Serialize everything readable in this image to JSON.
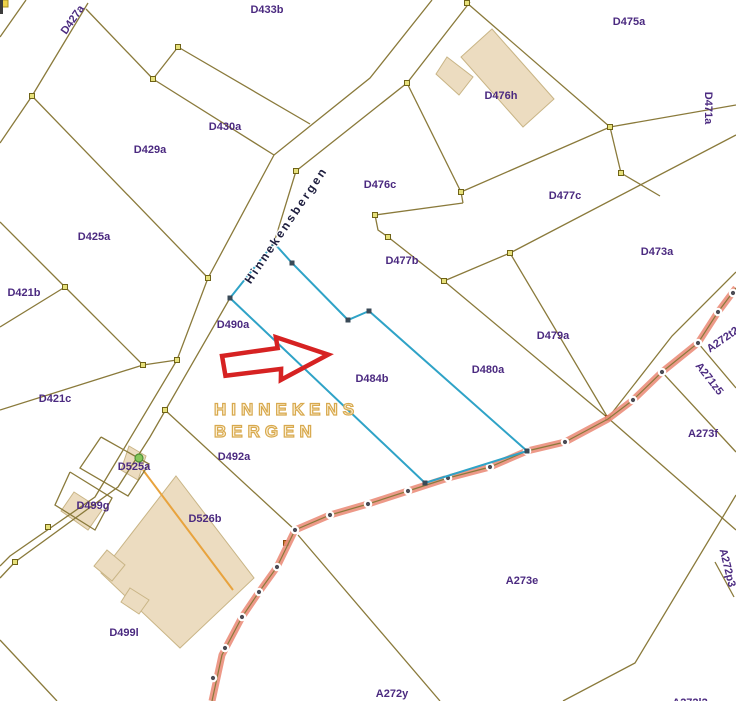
{
  "map": {
    "street_label": "Hinnekensbergen",
    "toponym": {
      "line1": "HINNEKENS",
      "line2": "BERGEN"
    },
    "colors": {
      "background": "#ffffff",
      "boundary": "#8a7a3b",
      "vertex_fill": "#e6e07a",
      "vertex_stroke": "#6f6318",
      "highlight_blue": "#2fa3c7",
      "blue_vertex": "#394a57",
      "road_fill": "#eb8e7b",
      "road_centerline": "#8a7a3b",
      "survey_dot": "#4c4c55",
      "survey_dot_ring": "#ffffff",
      "building_fill": "#ecdcc0",
      "building_stroke": "#c9b586",
      "parcel_label": "#4b2a80",
      "street_text": "#1d1d3e",
      "toponym_gold": "#d8a94e",
      "arrow_red": "#d62222",
      "orange_line": "#e8a33d",
      "orange_vertex": "#cf7a2e",
      "green_dot": "#86c65a"
    },
    "parcel_labels": [
      {
        "t": "D427a",
        "x": 73,
        "y": 20,
        "r": -55
      },
      {
        "t": "D433b",
        "x": 267,
        "y": 10,
        "r": 0
      },
      {
        "t": "D475a",
        "x": 629,
        "y": 22,
        "r": 0
      },
      {
        "t": "D476h",
        "x": 501,
        "y": 96,
        "r": 0
      },
      {
        "t": "D430a",
        "x": 225,
        "y": 127,
        "r": 0
      },
      {
        "t": "D429a",
        "x": 150,
        "y": 150,
        "r": 0
      },
      {
        "t": "D471a",
        "x": 708,
        "y": 108,
        "r": 90
      },
      {
        "t": "D476c",
        "x": 380,
        "y": 185,
        "r": 0
      },
      {
        "t": "D477c",
        "x": 565,
        "y": 196,
        "r": 0
      },
      {
        "t": "D425a",
        "x": 94,
        "y": 237,
        "r": 0
      },
      {
        "t": "D477b",
        "x": 402,
        "y": 261,
        "r": 0
      },
      {
        "t": "D473a",
        "x": 657,
        "y": 252,
        "r": 0
      },
      {
        "t": "D421b",
        "x": 24,
        "y": 293,
        "r": 0
      },
      {
        "t": "D490a",
        "x": 233,
        "y": 325,
        "r": 0
      },
      {
        "t": "D479a",
        "x": 553,
        "y": 336,
        "r": 0
      },
      {
        "t": "A272t2",
        "x": 723,
        "y": 340,
        "r": -35
      },
      {
        "t": "A271z5",
        "x": 709,
        "y": 379,
        "r": 52
      },
      {
        "t": "D421c",
        "x": 55,
        "y": 399,
        "r": 0
      },
      {
        "t": "D480a",
        "x": 488,
        "y": 370,
        "r": 0
      },
      {
        "t": "D484b",
        "x": 372,
        "y": 379,
        "r": 0
      },
      {
        "t": "A273f",
        "x": 703,
        "y": 434,
        "r": 0
      },
      {
        "t": "D492a",
        "x": 234,
        "y": 457,
        "r": 0
      },
      {
        "t": "D525a",
        "x": 134,
        "y": 467,
        "r": 0
      },
      {
        "t": "D499g",
        "x": 93,
        "y": 506,
        "r": 0
      },
      {
        "t": "D526b",
        "x": 205,
        "y": 519,
        "r": 0
      },
      {
        "t": "A272p3",
        "x": 727,
        "y": 568,
        "r": 76
      },
      {
        "t": "A273e",
        "x": 522,
        "y": 581,
        "r": 0
      },
      {
        "t": "D499l",
        "x": 124,
        "y": 633,
        "r": 0
      },
      {
        "t": "A272y",
        "x": 392,
        "y": 694,
        "r": 0
      },
      {
        "t": "A272l2",
        "x": 690,
        "y": 703,
        "r": 0
      }
    ],
    "geometry": {
      "boundaries": [
        [
          [
            26,
            0
          ],
          [
            0,
            37
          ]
        ],
        [
          [
            88,
            3
          ],
          [
            32,
            96
          ],
          [
            0,
            143
          ]
        ],
        [
          [
            86,
            9
          ],
          [
            153,
            79
          ]
        ],
        [
          [
            153,
            79
          ],
          [
            178,
            47
          ]
        ],
        [
          [
            178,
            47
          ],
          [
            310,
            124
          ]
        ],
        [
          [
            153,
            79
          ],
          [
            274,
            155
          ]
        ],
        [
          [
            32,
            96
          ],
          [
            208,
            278
          ]
        ],
        [
          [
            0,
            222
          ],
          [
            65,
            287
          ]
        ],
        [
          [
            0,
            327
          ],
          [
            65,
            287
          ]
        ],
        [
          [
            65,
            287
          ],
          [
            143,
            365
          ]
        ],
        [
          [
            143,
            365
          ],
          [
            177,
            360
          ]
        ],
        [
          [
            143,
            365
          ],
          [
            0,
            410
          ]
        ],
        [
          [
            432,
            0
          ],
          [
            370,
            78
          ],
          [
            274,
            155
          ],
          [
            208,
            278
          ],
          [
            177,
            360
          ],
          [
            95,
            497
          ],
          [
            10,
            556
          ],
          [
            0,
            566
          ]
        ],
        [
          [
            470,
            2
          ],
          [
            407,
            83
          ],
          [
            296,
            171
          ],
          [
            274,
            243
          ],
          [
            230,
            298
          ],
          [
            150,
            437
          ],
          [
            118,
            487
          ],
          [
            15,
            562
          ],
          [
            0,
            578
          ]
        ],
        [
          [
            467,
            3
          ],
          [
            610,
            127
          ]
        ],
        [
          [
            610,
            127
          ],
          [
            736,
            105
          ]
        ],
        [
          [
            407,
            83
          ],
          [
            461,
            192
          ]
        ],
        [
          [
            461,
            192
          ],
          [
            610,
            127
          ]
        ],
        [
          [
            610,
            127
          ],
          [
            621,
            173
          ],
          [
            660,
            196
          ]
        ],
        [
          [
            510,
            253
          ],
          [
            736,
            135
          ]
        ],
        [
          [
            463,
            203
          ],
          [
            461,
            192
          ]
        ],
        [
          [
            463,
            203
          ],
          [
            375,
            215
          ],
          [
            378,
            230
          ],
          [
            388,
            237
          ],
          [
            444,
            281
          ]
        ],
        [
          [
            444,
            281
          ],
          [
            510,
            253
          ]
        ],
        [
          [
            510,
            253
          ],
          [
            608,
            418
          ]
        ],
        [
          [
            444,
            281
          ],
          [
            608,
            418
          ]
        ],
        [
          [
            736,
            272
          ],
          [
            672,
            336
          ],
          [
            608,
            418
          ]
        ],
        [
          [
            698,
            343
          ],
          [
            736,
            388
          ]
        ],
        [
          [
            662,
            372
          ],
          [
            736,
            452
          ]
        ],
        [
          [
            608,
            418
          ],
          [
            736,
            530
          ]
        ],
        [
          [
            736,
            495
          ],
          [
            635,
            663
          ],
          [
            563,
            701
          ]
        ],
        [
          [
            715,
            562
          ],
          [
            734,
            597
          ]
        ],
        [
          [
            298,
            535
          ],
          [
            440,
            701
          ]
        ],
        [
          [
            165,
            410
          ],
          [
            295,
            530
          ]
        ],
        [
          [
            0,
            640
          ],
          [
            57,
            701
          ]
        ],
        [
          [
            101,
            437
          ],
          [
            149,
            464
          ],
          [
            128,
            496
          ],
          [
            80,
            468
          ],
          [
            101,
            437
          ]
        ],
        [
          [
            70,
            472
          ],
          [
            112,
            498
          ],
          [
            95,
            530
          ],
          [
            55,
            505
          ],
          [
            70,
            472
          ]
        ]
      ],
      "orange_line": [
        [
          143,
          470
        ],
        [
          233,
          590
        ]
      ],
      "road": {
        "path": [
          [
            736,
            288
          ],
          [
            718,
            312
          ],
          [
            698,
            343
          ],
          [
            662,
            372
          ],
          [
            633,
            400
          ],
          [
            608,
            419
          ],
          [
            565,
            442
          ],
          [
            527,
            451
          ],
          [
            490,
            467
          ],
          [
            448,
            478
          ],
          [
            408,
            491
          ],
          [
            368,
            504
          ],
          [
            330,
            515
          ],
          [
            295,
            530
          ],
          [
            277,
            567
          ],
          [
            259,
            592
          ],
          [
            242,
            617
          ],
          [
            222,
            655
          ],
          [
            212,
            701
          ]
        ],
        "dots": [
          [
            733,
            293
          ],
          [
            718,
            312
          ],
          [
            698,
            343
          ],
          [
            662,
            372
          ],
          [
            633,
            400
          ],
          [
            565,
            442
          ],
          [
            527,
            451
          ],
          [
            490,
            467
          ],
          [
            448,
            478
          ],
          [
            408,
            491
          ],
          [
            368,
            504
          ],
          [
            330,
            515
          ],
          [
            295,
            530
          ],
          [
            277,
            567
          ],
          [
            259,
            592
          ],
          [
            242,
            617
          ],
          [
            225,
            648
          ],
          [
            213,
            678
          ]
        ]
      },
      "blue_parcel": [
        [
          274,
          243
        ],
        [
          292,
          263
        ],
        [
          348,
          320
        ],
        [
          369,
          311
        ],
        [
          527,
          451
        ],
        [
          425,
          483
        ],
        [
          230,
          298
        ]
      ],
      "vertices": [
        [
          32,
          96
        ],
        [
          65,
          287
        ],
        [
          143,
          365
        ],
        [
          177,
          360
        ],
        [
          153,
          79
        ],
        [
          178,
          47
        ],
        [
          208,
          278
        ],
        [
          296,
          171
        ],
        [
          407,
          83
        ],
        [
          467,
          3
        ],
        [
          461,
          192
        ],
        [
          610,
          127
        ],
        [
          621,
          173
        ],
        [
          510,
          253
        ],
        [
          444,
          281
        ],
        [
          375,
          215
        ],
        [
          388,
          237
        ],
        [
          165,
          410
        ],
        [
          15,
          562
        ],
        [
          48,
          527
        ]
      ],
      "orange_vertices": [
        [
          286,
          543
        ],
        [
          608,
          418
        ]
      ],
      "buildings": [
        [
          [
            492,
            29
          ],
          [
            554,
            99
          ],
          [
            523,
            127
          ],
          [
            461,
            57
          ]
        ],
        [
          [
            447,
            57
          ],
          [
            473,
            77
          ],
          [
            459,
            95
          ],
          [
            436,
            74
          ]
        ],
        [
          [
            176,
            476
          ],
          [
            254,
            578
          ],
          [
            180,
            648
          ],
          [
            101,
            573
          ]
        ],
        [
          [
            107,
            550
          ],
          [
            125,
            565
          ],
          [
            112,
            581
          ],
          [
            94,
            566
          ]
        ],
        [
          [
            130,
            588
          ],
          [
            149,
            600
          ],
          [
            139,
            614
          ],
          [
            121,
            602
          ]
        ],
        [
          [
            129,
            446
          ],
          [
            146,
            456
          ],
          [
            138,
            480
          ],
          [
            121,
            470
          ]
        ],
        [
          [
            74,
            492
          ],
          [
            102,
            510
          ],
          [
            88,
            530
          ],
          [
            61,
            511
          ]
        ]
      ],
      "green_dot": [
        139,
        458
      ],
      "arrow": {
        "x": 221,
        "y": 341,
        "rotate": -4,
        "points": [
          [
            0,
            15
          ],
          [
            56,
            11
          ],
          [
            55,
            0
          ],
          [
            106,
            21
          ],
          [
            57,
            43
          ],
          [
            58,
            32
          ],
          [
            2,
            35
          ]
        ]
      },
      "corner_marks": {
        "yellow_square": [
          0,
          0,
          8,
          7
        ],
        "dark_bar": [
          0,
          0,
          3,
          14
        ]
      }
    }
  }
}
